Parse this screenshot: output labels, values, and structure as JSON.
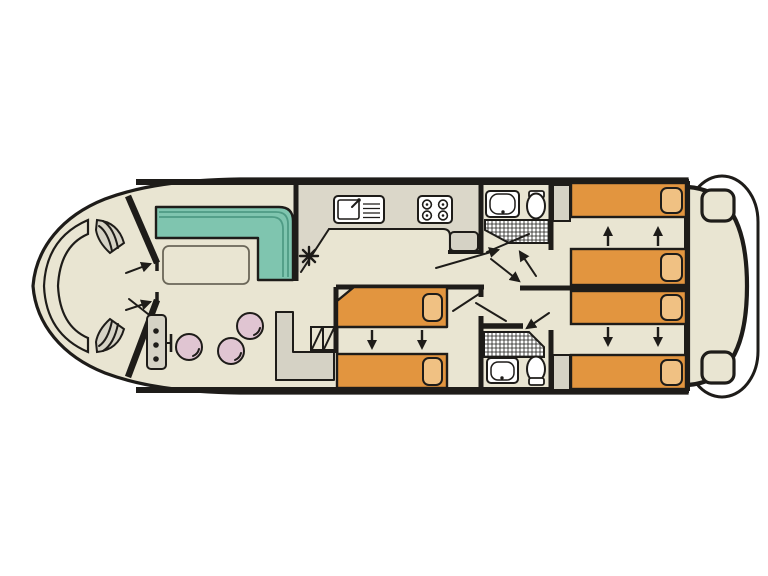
{
  "meta": {
    "title": "Canal boat deck plan (top view, bow at left)",
    "diagram_type": "boat-floor-plan",
    "visible_text": "none"
  },
  "colors": {
    "bg": "#FFFFFF",
    "cream": "#E9E5D2",
    "counter": "#DBD7C9",
    "gray": "#D5D2C5",
    "teal": "#7FC5AF",
    "sofa_stripe": "#4F9B85",
    "orange": "#E2953F",
    "pillow": "#F0C183",
    "pink": "#E0C5D2",
    "outline": "#1E1C19"
  },
  "rooms": [
    {
      "id": "bow-deck",
      "items": [
        "curved-bow-bench",
        "port-step",
        "starboard-step",
        "entry-door-opening",
        "door-swing-lines"
      ]
    },
    {
      "id": "saloon",
      "items": [
        "l-shaped-sofa-teal",
        "dining-table",
        "round-stool-1",
        "round-stool-2",
        "round-stool-3",
        "helm-console-with-3-dials",
        "throttle-lever",
        "l-shaped-side-counter",
        "companionway-steps"
      ]
    },
    {
      "id": "galley",
      "items": [
        "worktop",
        "sink-with-drainer",
        "hob-4-burners",
        "fridge-unit",
        "asterisk-symbol"
      ]
    },
    {
      "id": "shower-room-forward",
      "items": [
        "washbasin",
        "toilet",
        "shower-hatched-tray",
        "door-leaf"
      ]
    },
    {
      "id": "cabin-midship",
      "items": [
        "single-bed-with-pillow-upper",
        "single-bed-with-pillow-lower",
        "slide-together-arrows-down"
      ]
    },
    {
      "id": "shower-room-aft",
      "items": [
        "washbasin",
        "toilet",
        "shower-hatched-tray",
        "door-leaf"
      ]
    },
    {
      "id": "cabin-aft-starboard",
      "items": [
        "wardrobe",
        "single-bed-with-pillow",
        "single-bed-with-pillow",
        "slide-together-arrows-up"
      ]
    },
    {
      "id": "cabin-aft-port",
      "items": [
        "wardrobe",
        "single-bed-with-pillow",
        "single-bed-with-pillow",
        "slide-together-arrows-down"
      ]
    },
    {
      "id": "stern",
      "items": [
        "aft-deck",
        "stern-step-starboard",
        "stern-step-port",
        "swim-platform"
      ]
    }
  ],
  "symbols": [
    {
      "name": "hatched-square",
      "meaning-on-plan": "shower tray"
    },
    {
      "name": "double-arrows",
      "meaning-on-plan": "beds slide together"
    },
    {
      "name": "asterisk",
      "location": "galley corridor"
    }
  ]
}
